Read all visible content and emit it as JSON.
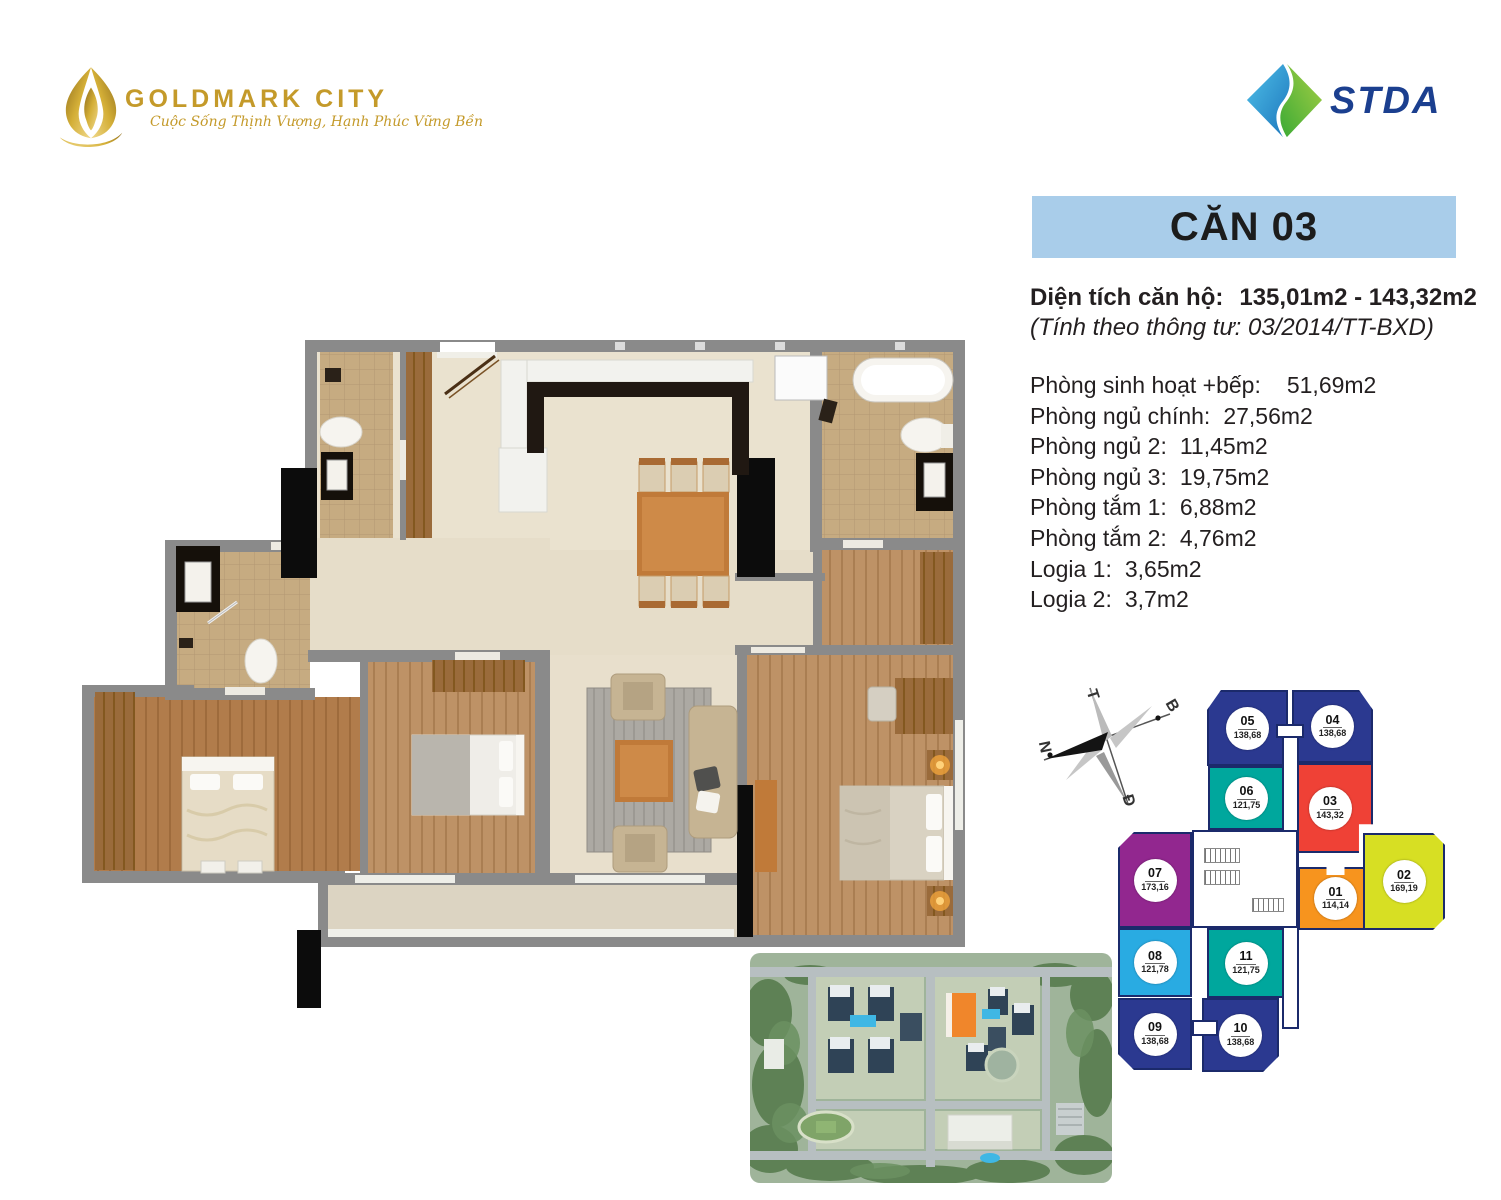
{
  "header": {
    "brand": {
      "name": "GOLDMARK CITY",
      "tagline": "Cuộc Sống Thịnh Vượng, Hạnh Phúc Vững Bền",
      "color": "#C49A2A"
    },
    "partner": {
      "name": "STDA",
      "color": "#1B3F8F",
      "logo_blue": "#2D9FD8",
      "logo_green": "#7DBE42"
    }
  },
  "apartment": {
    "title": "CĂN 03",
    "title_bg": "#A9CDEA",
    "area_label": "Diện tích căn hộ:",
    "area_value": "135,01m2 - 143,32m2",
    "area_note": "(Tính theo thông tư: 03/2014/TT-BXD)",
    "rooms": [
      {
        "label": "Phòng sinh hoạt +bếp:",
        "value": "51,69m2"
      },
      {
        "label": "Phòng ngủ chính:",
        "value": "27,56m2"
      },
      {
        "label": "Phòng ngủ 2:",
        "value": "11,45m2"
      },
      {
        "label": "Phòng ngủ 3:",
        "value": "19,75m2"
      },
      {
        "label": "Phòng tắm 1:",
        "value": "6,88m2"
      },
      {
        "label": "Phòng tắm 2:",
        "value": "4,76m2"
      },
      {
        "label": "Logia 1:",
        "value": "3,65m2"
      },
      {
        "label": "Logia 2:",
        "value": "3,7m2"
      }
    ]
  },
  "compass": {
    "labels": {
      "north": "B",
      "south": "N",
      "west": "T",
      "east": "Đ"
    }
  },
  "floor_diagram": {
    "highlighted_unit": "03",
    "units": [
      {
        "id": "01",
        "area": "114,14",
        "color": "#F7941E"
      },
      {
        "id": "02",
        "area": "169,19",
        "color": "#D7DF23"
      },
      {
        "id": "03",
        "area": "143,32",
        "color": "#EF4136"
      },
      {
        "id": "04",
        "area": "138,68",
        "color": "#2B3990"
      },
      {
        "id": "05",
        "area": "138,68",
        "color": "#2B3990"
      },
      {
        "id": "06",
        "area": "121,75",
        "color": "#00A79D"
      },
      {
        "id": "07",
        "area": "173,16",
        "color": "#92278F"
      },
      {
        "id": "08",
        "area": "121,78",
        "color": "#29ABE2"
      },
      {
        "id": "09",
        "area": "138,68",
        "color": "#2B3990"
      },
      {
        "id": "10",
        "area": "138,68",
        "color": "#2B3990"
      },
      {
        "id": "11",
        "area": "121,75",
        "color": "#00A79D"
      }
    ]
  }
}
